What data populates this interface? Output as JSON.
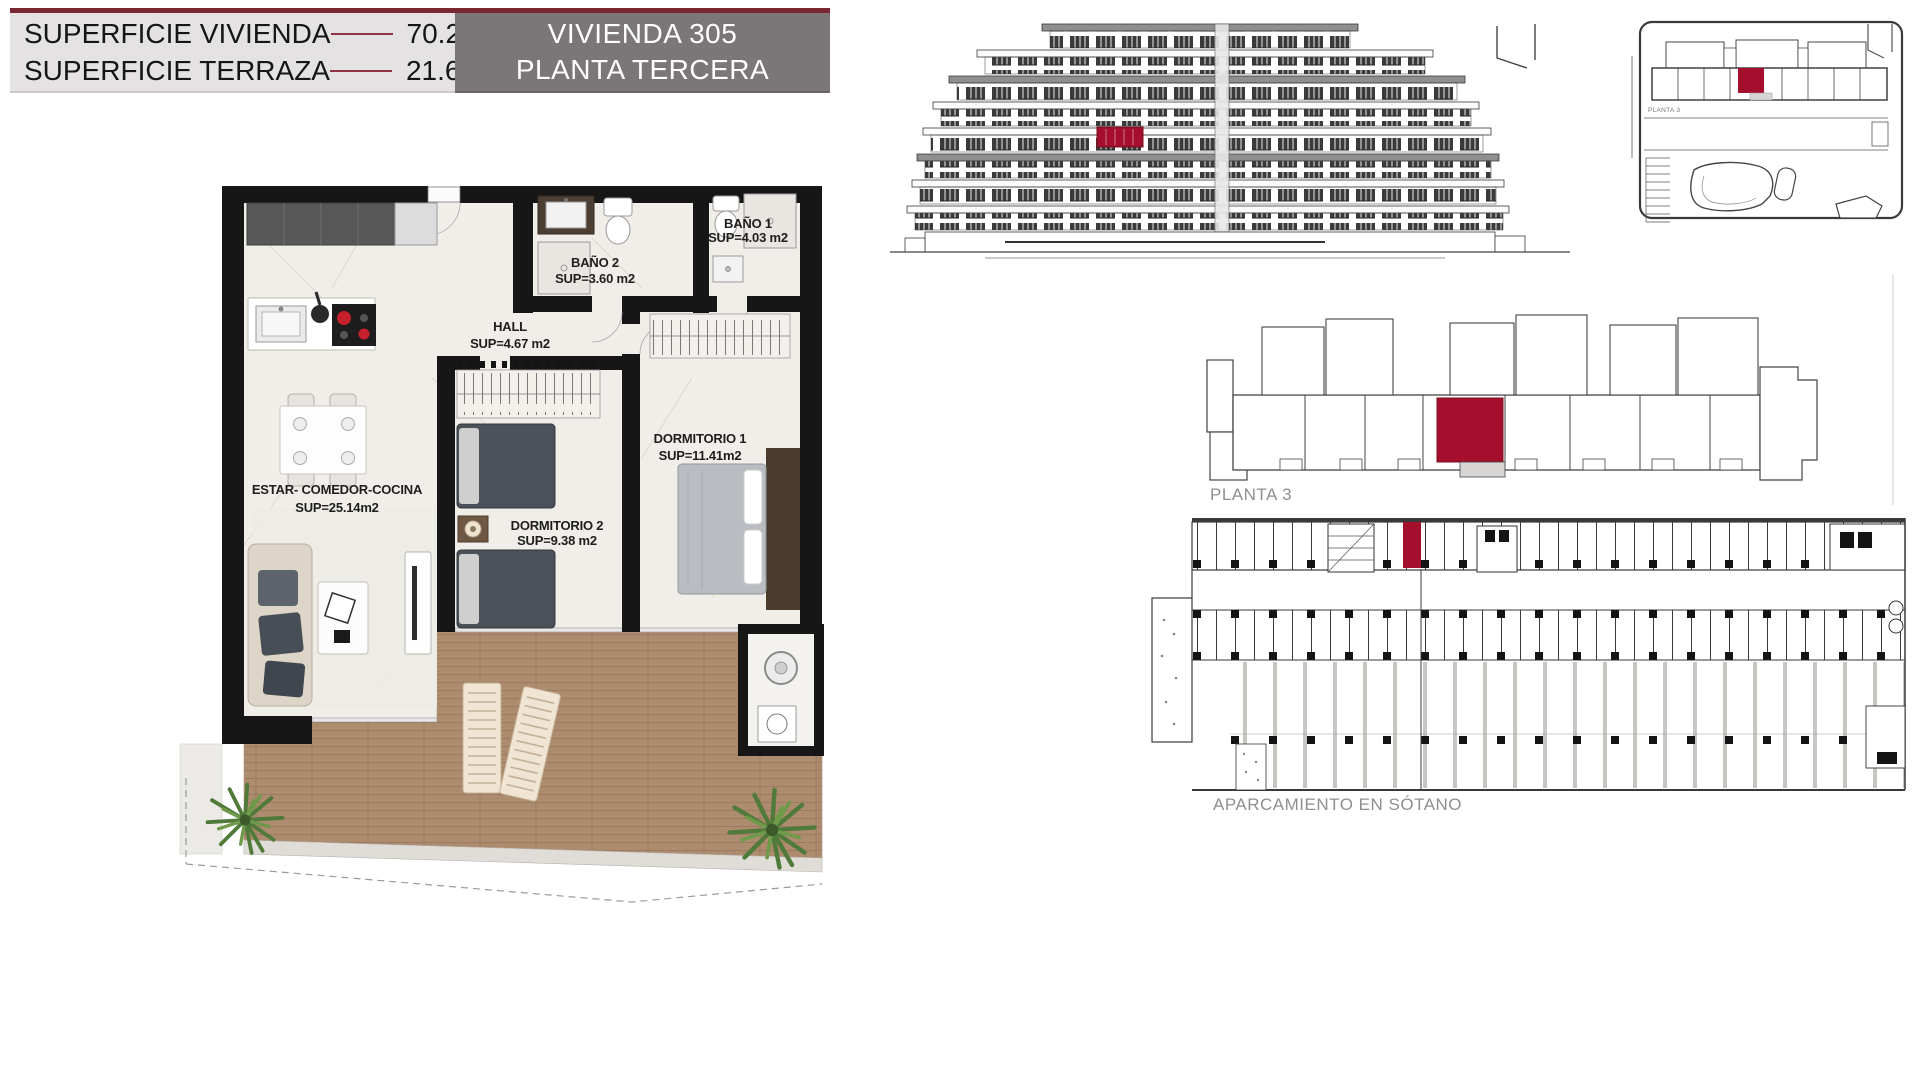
{
  "header": {
    "rows": [
      {
        "label": "SUPERFICIE VIVIENDA",
        "value": "70.20 m2"
      },
      {
        "label": "SUPERFICIE TERRAZA",
        "value": "21.65 m2"
      }
    ],
    "unit_box": {
      "line1": "VIVIENDA 305",
      "line2": "PLANTA TERCERA"
    }
  },
  "floorplan": {
    "rooms": [
      {
        "name": "ESTAR-  COMEDOR-COCINA",
        "area": "SUP=25.14m2"
      },
      {
        "name": "HALL",
        "area": "SUP=4.67  m2"
      },
      {
        "name": "BAÑO  2",
        "area": "SUP=3.60  m2"
      },
      {
        "name": "BAÑO  1",
        "area": "SUP=4.03  m2"
      },
      {
        "name": "DORMITORIO  1",
        "area": "SUP=11.41m2"
      },
      {
        "name": "DORMITORIO  2",
        "area": "SUP=9.38  m2"
      }
    ]
  },
  "plans": {
    "floor_overview_label": "PLANTA 3",
    "site_plan_label": "PLANTA 3",
    "parking_label": "APARCAMIENTO EN SÓTANO"
  },
  "colors": {
    "accent_red": "#A50F2D",
    "maroon_bar": "#7A2733",
    "header_panel_bg": "#E4E2E3",
    "unit_box_bg": "#7B7779",
    "wall_black": "#161616",
    "wood_deck": "#AD8B6E",
    "marble_floor": "#F1EEE9",
    "drawing_line": "#3A3A3A",
    "muted_label": "#8F8F8F"
  }
}
